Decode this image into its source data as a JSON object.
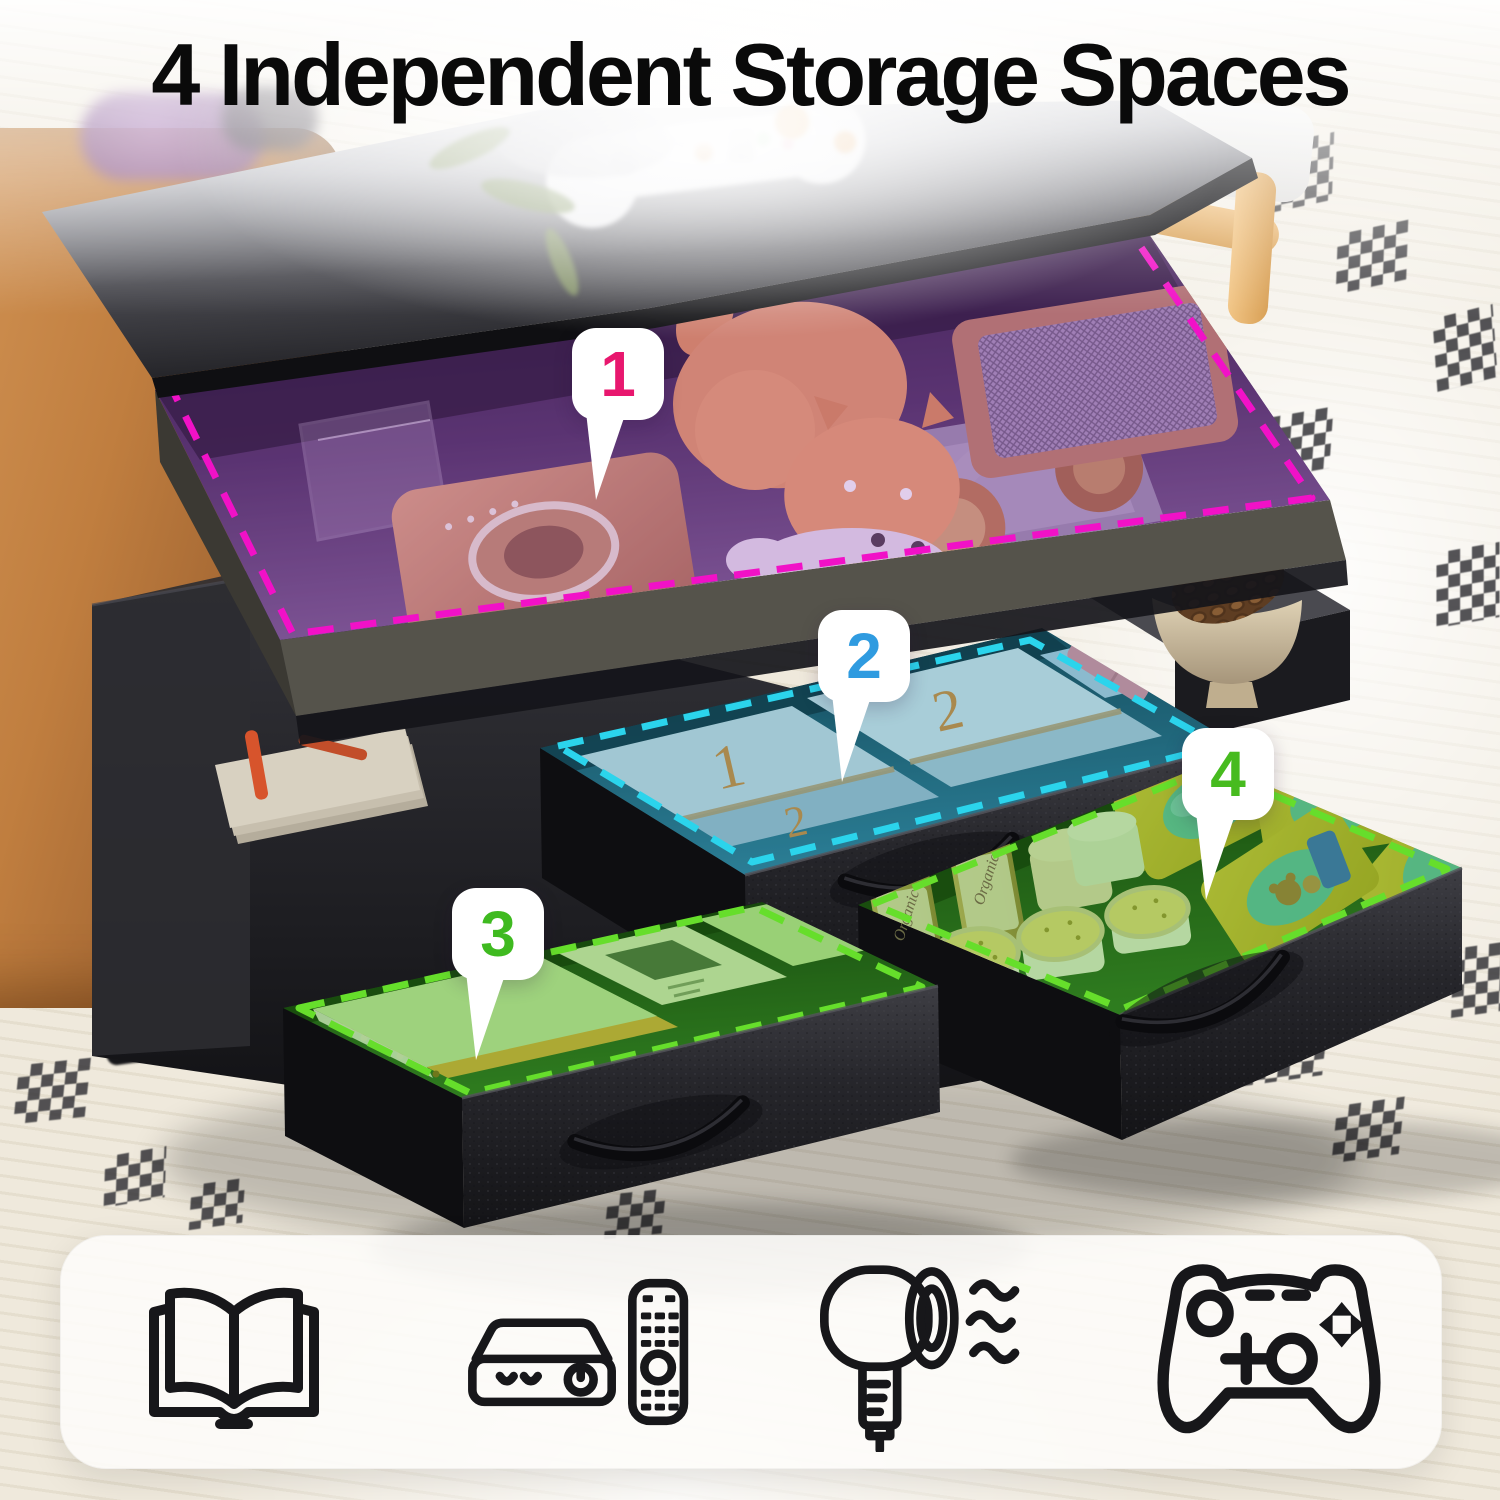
{
  "title": "4 Independent Storage Spaces",
  "callouts": [
    {
      "label": "1",
      "number_color": "#E8176E",
      "dash_color": "#F111C7"
    },
    {
      "label": "2",
      "number_color": "#2F9BE0",
      "dash_color": "#2BD4EC"
    },
    {
      "label": "3",
      "number_color": "#3FBA20",
      "dash_color": "#66DE2B"
    },
    {
      "label": "4",
      "number_color": "#47BB1F",
      "dash_color": "#66DE2B"
    }
  ],
  "drawer2": {
    "box_numbers": [
      "1",
      "2",
      "2"
    ]
  },
  "drawer4": {
    "jar_label": "Organic"
  },
  "legend": {
    "icons": [
      {
        "name": "open-book-icon"
      },
      {
        "name": "media-player-and-remote-icon"
      },
      {
        "name": "hair-dryer-icon"
      },
      {
        "name": "game-controller-icon"
      }
    ]
  }
}
